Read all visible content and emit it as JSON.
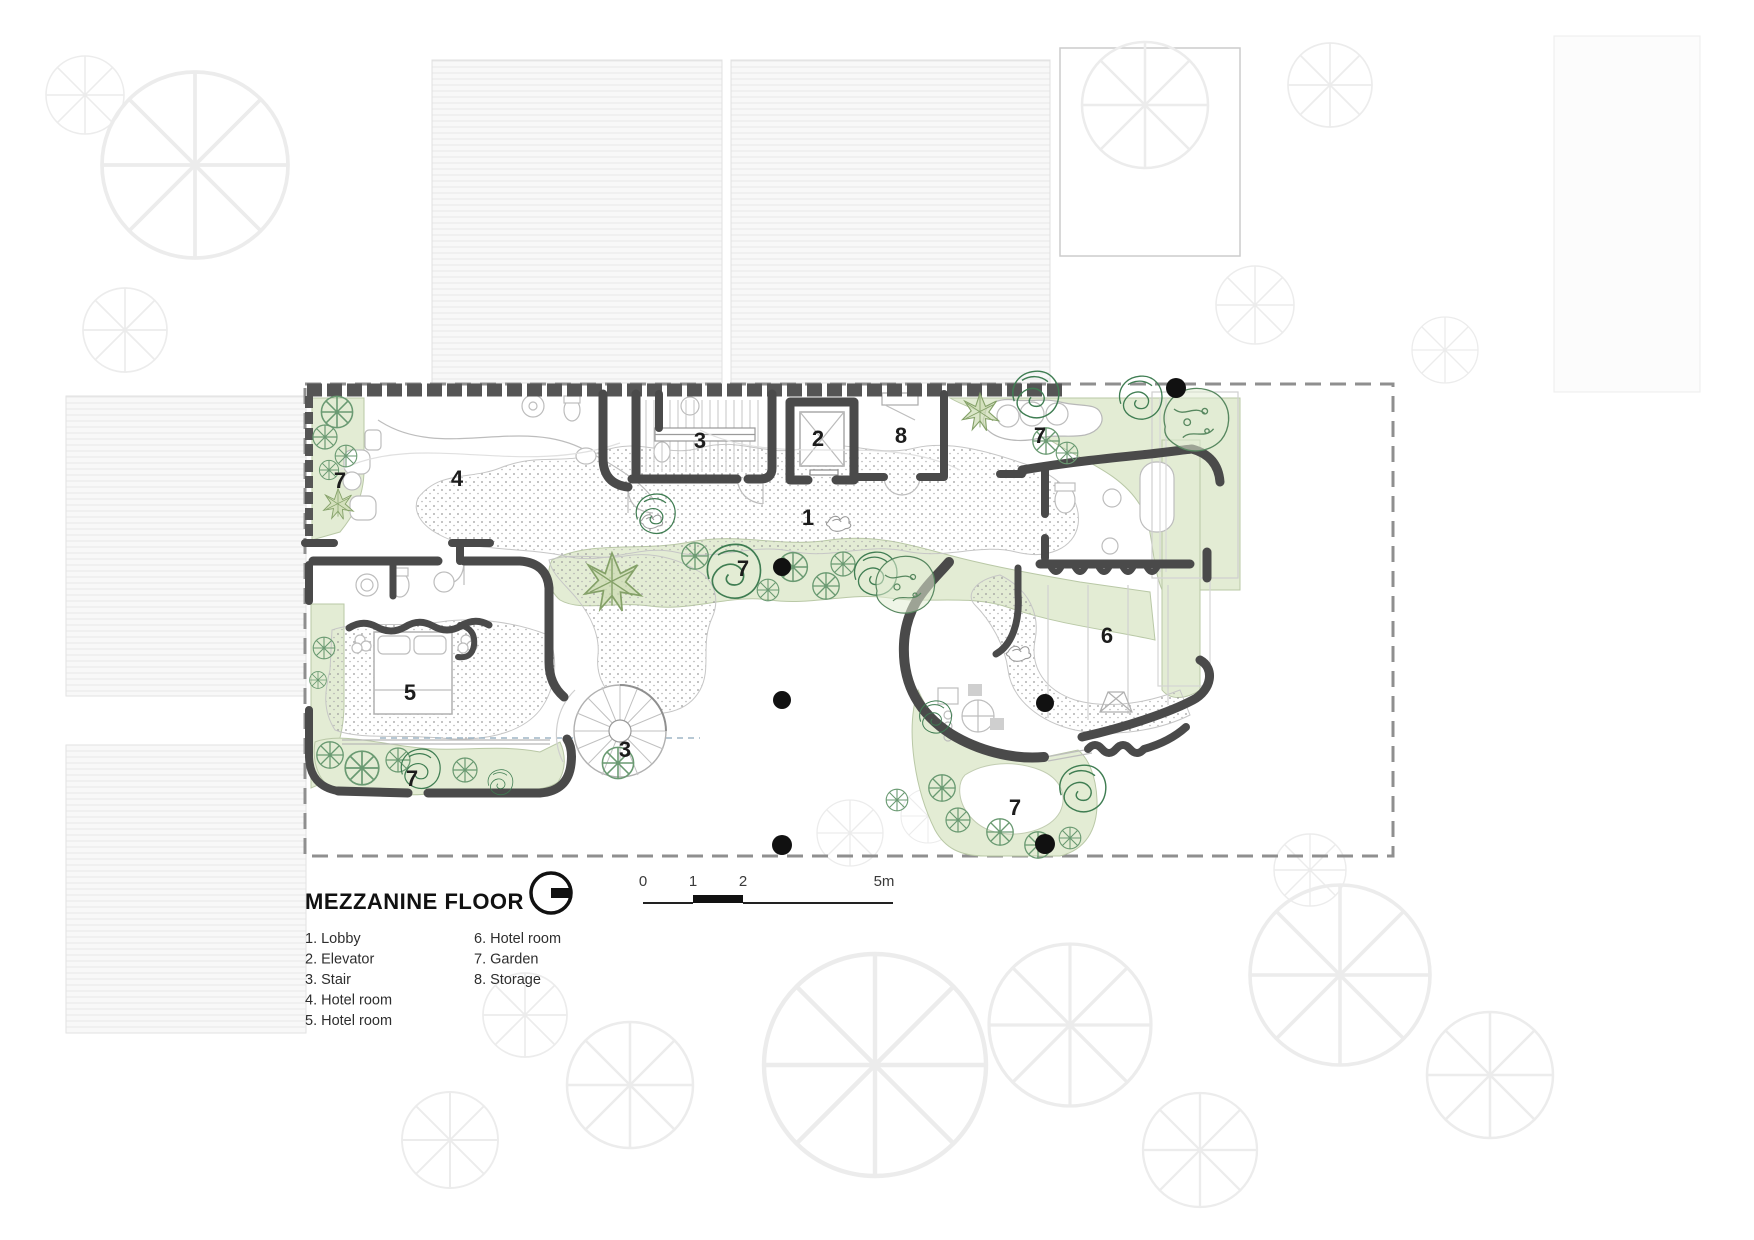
{
  "title": "MEZZANINE FLOOR",
  "plan": {
    "room_labels": [
      {
        "text": "7",
        "room": "garden-top-left"
      },
      {
        "text": "4",
        "room": "hotel-room-4"
      },
      {
        "text": "3",
        "room": "stair-top"
      },
      {
        "text": "2",
        "room": "elevator"
      },
      {
        "text": "8",
        "room": "storage"
      },
      {
        "text": "7",
        "room": "garden-top-right"
      },
      {
        "text": "1",
        "room": "lobby"
      },
      {
        "text": "7",
        "room": "garden-center"
      },
      {
        "text": "6",
        "room": "hotel-room-6"
      },
      {
        "text": "5",
        "room": "hotel-room-5"
      },
      {
        "text": "3",
        "room": "spiral-stair"
      },
      {
        "text": "7",
        "room": "garden-bottom-left"
      },
      {
        "text": "7",
        "room": "garden-bottom-right"
      }
    ]
  },
  "legend": {
    "column1": [
      "1. Lobby",
      "2. Elevator",
      "3. Stair",
      "4. Hotel room",
      "5. Hotel room"
    ],
    "column2": [
      "6. Hotel room",
      "7. Garden",
      "8. Storage"
    ]
  },
  "scale_bar": {
    "tick0": "0",
    "tick1": "1",
    "tick2": "2",
    "end": "5m"
  },
  "icons": {
    "north": "north-arrow-icon",
    "tree": "tree-icon",
    "column": "column-dot"
  },
  "colors": {
    "wall": "#4a4a4a",
    "boundary_dash": "#8f8f8f",
    "garden_fill": "#e3ecd4",
    "garden_edge": "#b9c8a6",
    "tree_stroke": "#5d8f68",
    "column_dot": "#111111"
  }
}
